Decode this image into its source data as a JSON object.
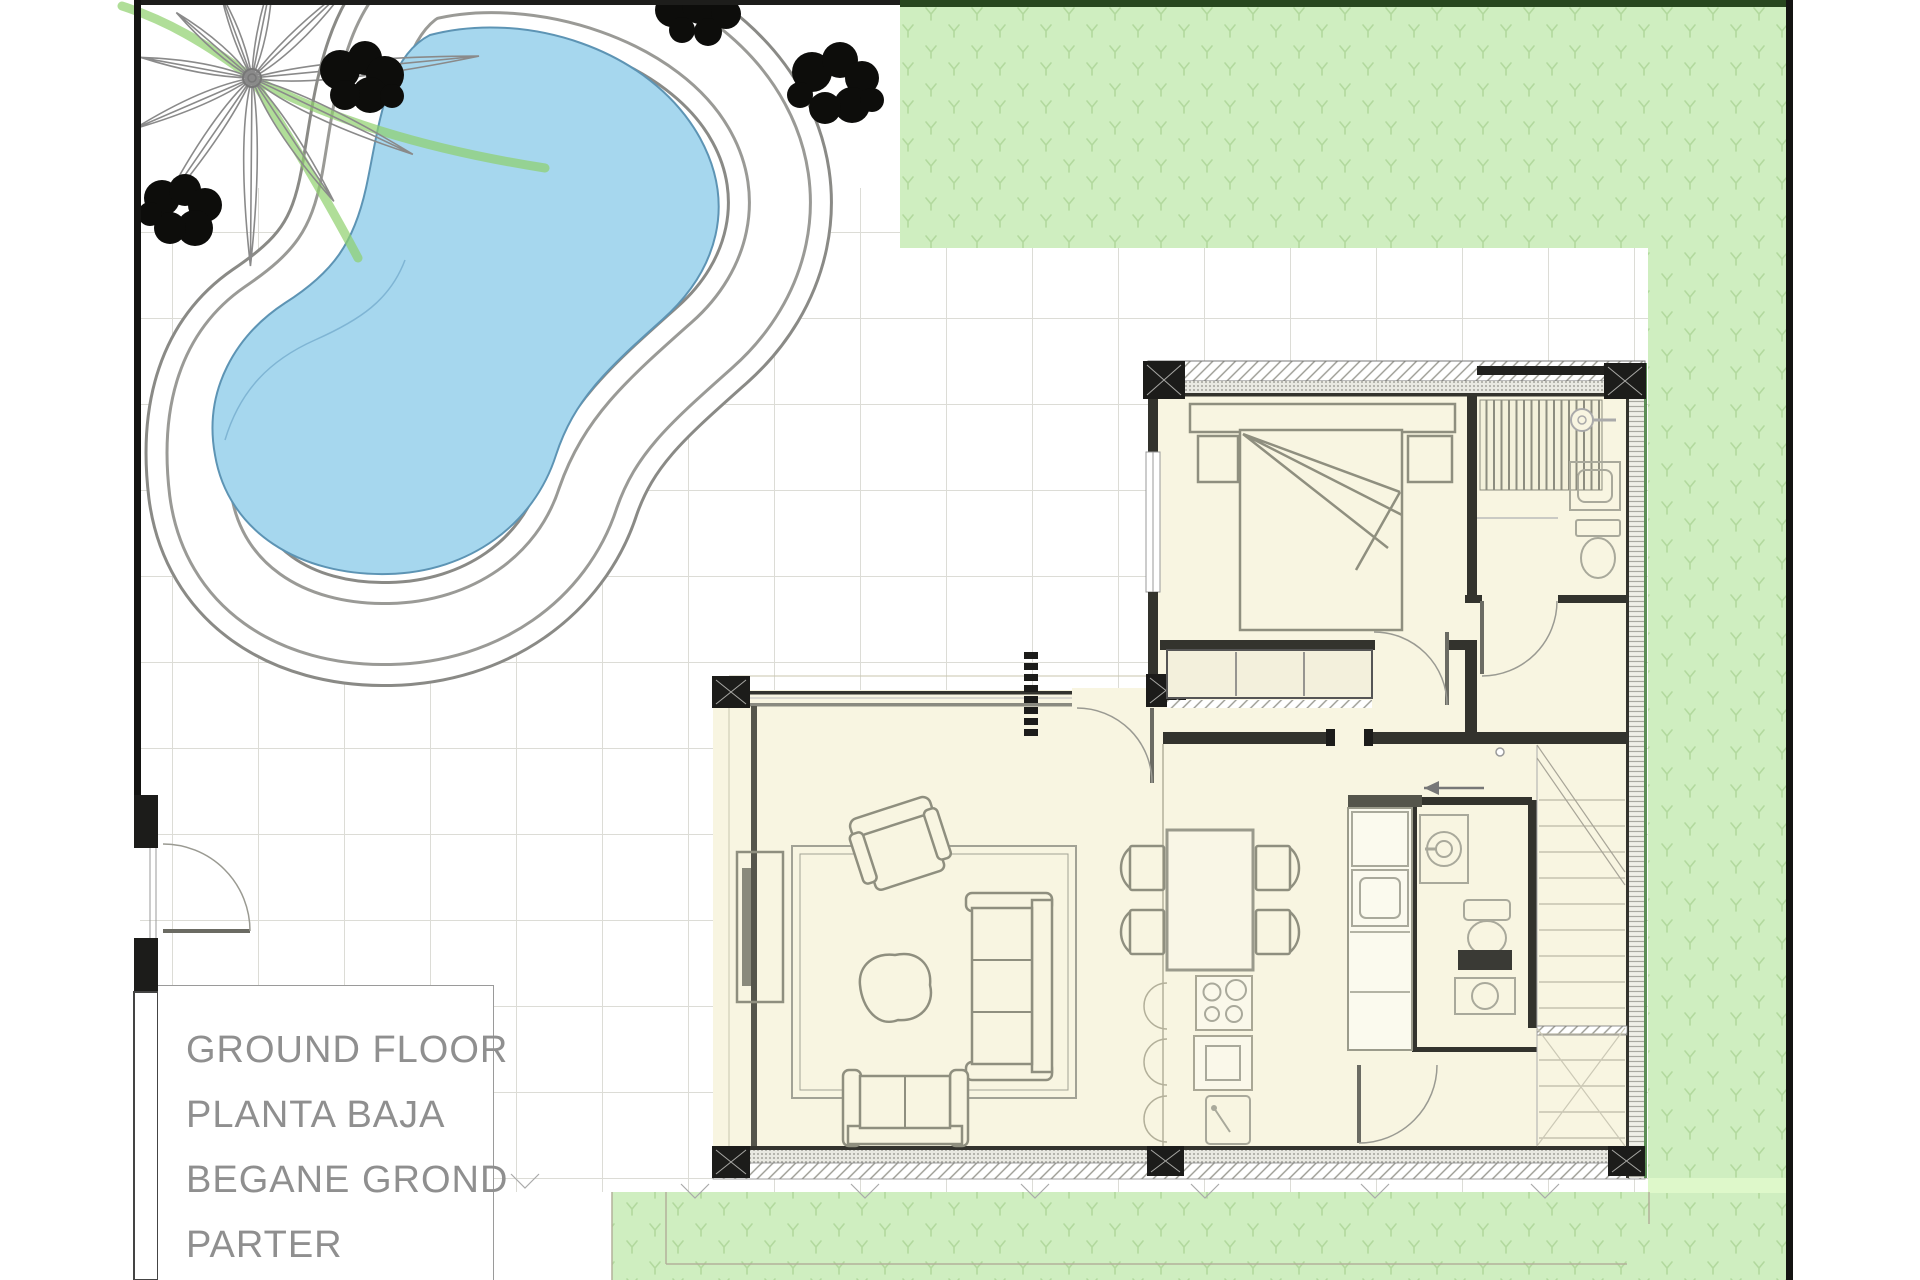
{
  "title_block": {
    "lines": [
      "GROUND FLOOR",
      "PLANTA BAJA",
      "BEGANE GROND",
      "PARTER"
    ]
  },
  "colors": {
    "panel_bg": "#ffffff",
    "label_text": "#8f8f8f",
    "grid_line": "#dcdcd6",
    "pool_water": "#a6d7ee",
    "pool_water_edge": "#5d94b4",
    "deck_rim": "#8a8a86",
    "deck_inner_line": "#9a9a96",
    "grass": "#cfeec0",
    "grass_tuft": "#b2d99e",
    "grass_band": "#def8ca",
    "grass_border_top": "#28471f",
    "floor": "#f8f5e1",
    "wall_dark": "#33332d",
    "wall_hatch": "#9a9a92",
    "column": "#1c1c1a",
    "furniture": "#8f8f7f",
    "fixture": "#a9a99b",
    "boundary": "#141412",
    "tree": "#8a8a8a",
    "tree_green": "#8fd06c",
    "bush": "#0d0d0b"
  }
}
